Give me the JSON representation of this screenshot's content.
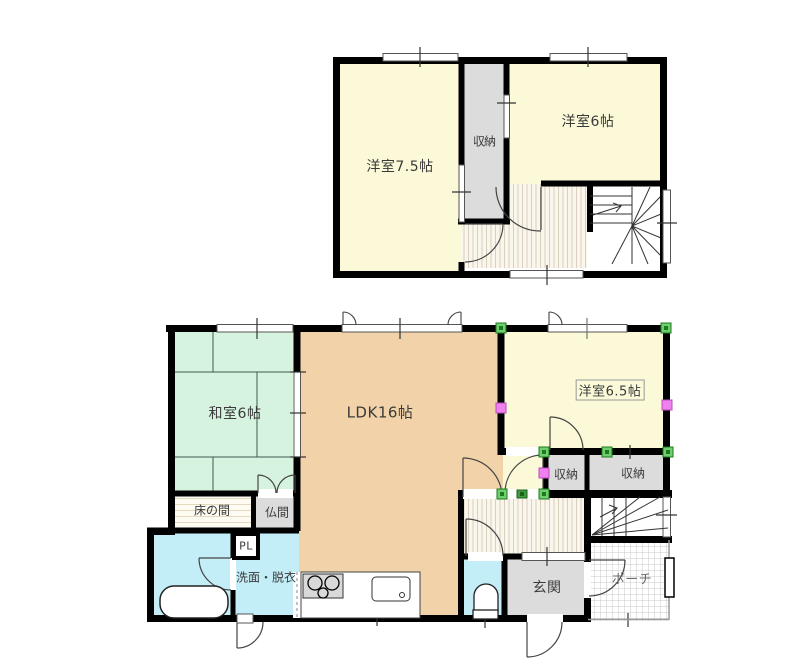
{
  "plan_title": "2-story house floor plan",
  "colors": {
    "wall": "#000000",
    "western_room_cream": "#FBF9D8",
    "japanese_room_green": "#D6F3DF",
    "ldk_tan": "#F1D2A9",
    "storage_gray": "#DCDCDC",
    "wet_area_blue": "#C3EDF7",
    "marker_green": "#6FCF6F",
    "marker_magenta": "#F07FF0"
  },
  "floor2": {
    "rooms": [
      {
        "label": "洋室7.5帖"
      },
      {
        "label": "収納"
      },
      {
        "label": "洋室6帖"
      }
    ]
  },
  "floor1": {
    "rooms": [
      {
        "label": "和室6帖"
      },
      {
        "label": "LDK16帖"
      },
      {
        "label": "洋室6.5帖"
      },
      {
        "label": "収納"
      },
      {
        "label": "収納"
      },
      {
        "label": "床の間"
      },
      {
        "label": "仏間"
      },
      {
        "label": "PL"
      },
      {
        "label": "洗面・脱衣"
      },
      {
        "label": "玄関"
      },
      {
        "label": "ポーチ"
      }
    ]
  },
  "fixtures": [
    "bathtub",
    "toilet",
    "kitchen-stove",
    "kitchen-sink",
    "stairs-2f",
    "stairs-1f"
  ]
}
